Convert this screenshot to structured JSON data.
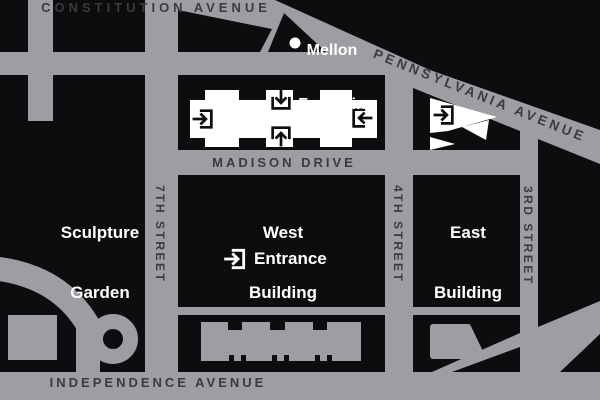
{
  "colors": {
    "road_gray": "#9c9ea1",
    "block_black": "#0c0d0f",
    "street_text": "#3b3b3d",
    "place_text": "#ffffff"
  },
  "streets": {
    "constitution": "CONSTITUTION AVENUE",
    "pennsylvania": "PENNSYLVANIA AVENUE",
    "madison": "MADISON DRIVE",
    "independence": "INDEPENDENCE AVENUE",
    "seventh": "7TH STREET",
    "fourth": "4TH STREET",
    "third": "3RD STREET"
  },
  "places": {
    "mellon": {
      "line1": "Mellon",
      "line2": "Fountain"
    },
    "sculpture": {
      "line1": "Sculpture",
      "line2": "Garden"
    },
    "west": {
      "line1": "West",
      "line2": "Building"
    },
    "east": {
      "line1": "East",
      "line2": "Building"
    }
  },
  "legend": {
    "entrance": "Entrance"
  },
  "icons": {
    "entrance_marker": "arrow-into-doorway"
  }
}
